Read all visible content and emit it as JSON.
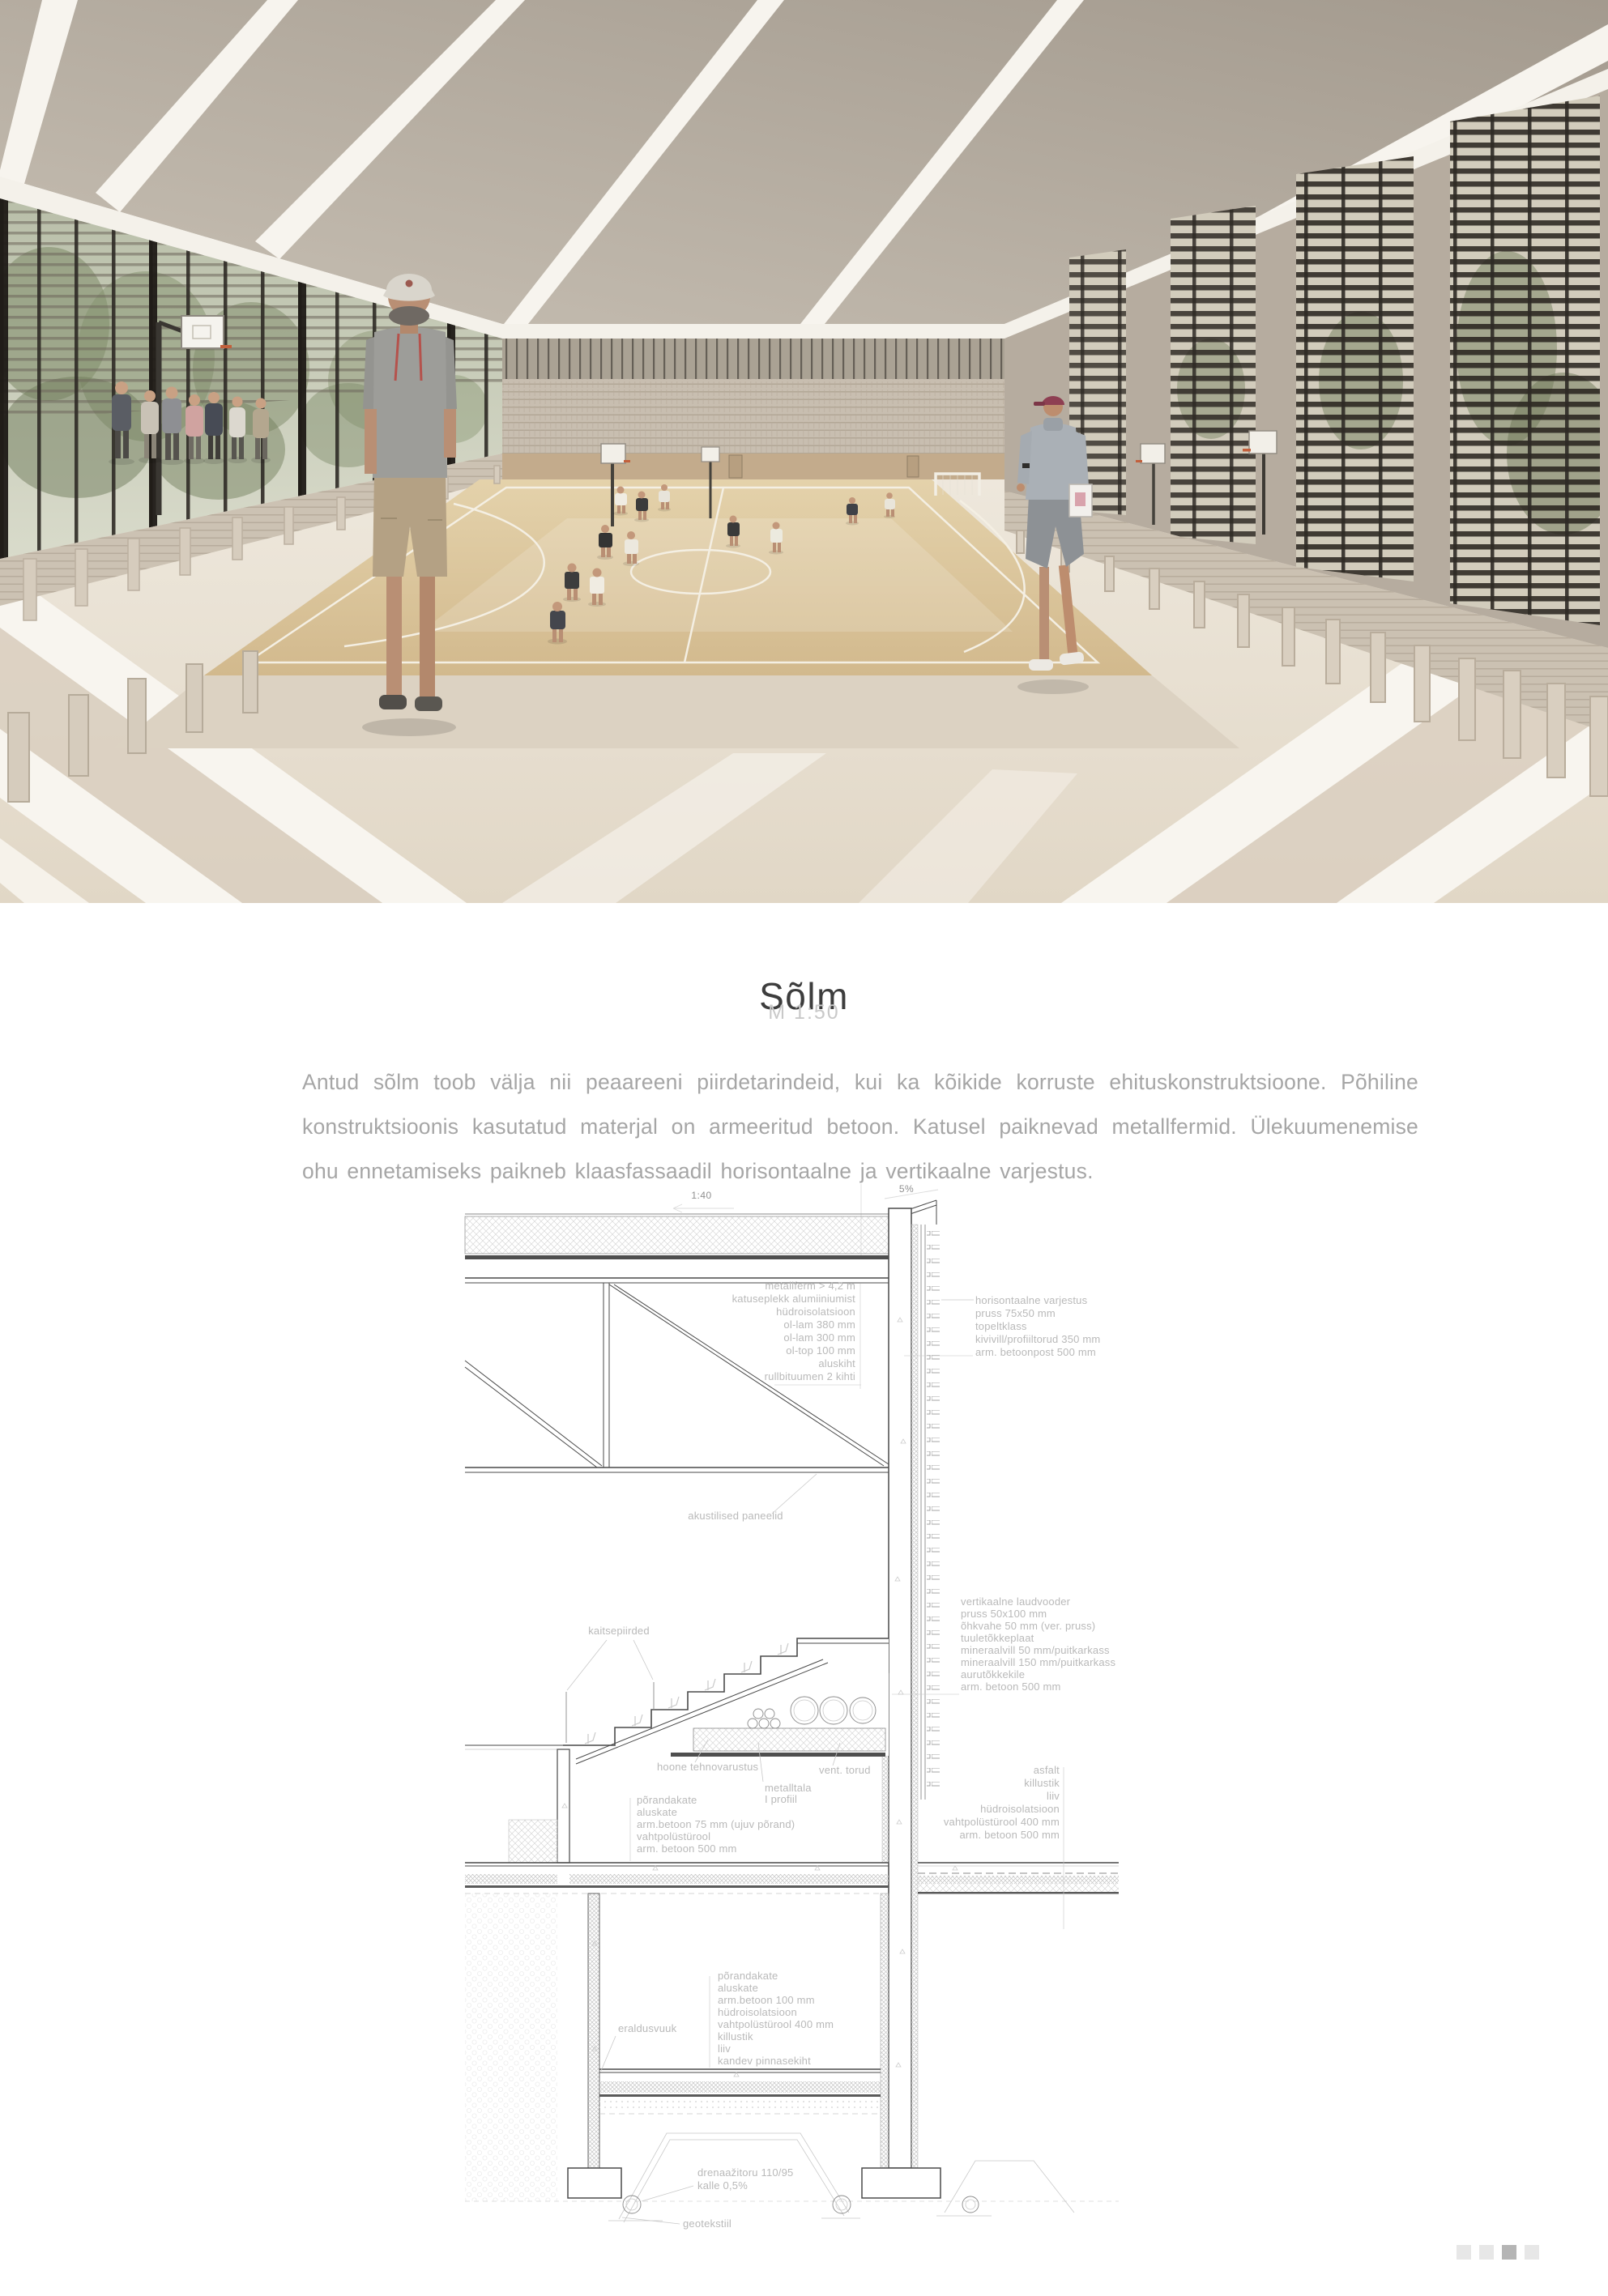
{
  "header": {
    "title": "Sõlm",
    "scale": "M 1:50"
  },
  "intro": {
    "paragraph": "Antud sõlm toob välja nii peaareeni piirdetarindeid, kui ka kõikide korruste ehituskonstruktsioone. Põhiline konstruktsioonis kasutatud materjal on armeeritud betoon. Katusel paiknevad metallfermid. Ülekuumenemise ohu ennetamiseks paikneb klaasfassaadil horisontaalne ja vertikaalne varjestus.",
    "colors": {
      "accent_gray": "#a6a6a6",
      "title": "#3d3d3d",
      "annotation": "#b9b9b9"
    }
  },
  "hero": {
    "colors": {
      "ceiling": "#b3a99e",
      "court": "#d8c096",
      "floor": "#e8e1d4",
      "glass_mullion": "#2e2a25",
      "stand": "#cdc3b4"
    }
  },
  "section": {
    "slope_roof": "1:40",
    "slope_parapet": "5%",
    "roof_layers": [
      "metallferm > 4,2 m",
      "katuseplekk alumiiniumist",
      "hüdroisolatsioon",
      "ol-lam 380 mm",
      "ol-lam 300 mm",
      "ol-top 100 mm",
      "aluskiht",
      "rullbituumen 2 kihti"
    ],
    "shading": [
      "horisontaalne varjestus",
      "pruss 75x50 mm",
      "topeltklass",
      "kivivill/profiiltorud 350 mm",
      "arm. betoonpost 500 mm"
    ],
    "acoustic_panels": "akustilised paneelid",
    "railings": "kaitsepiirded",
    "wall_layers": [
      "vertikaalne laudvooder",
      "pruss 50x100 mm",
      "õhkvahe 50 mm (ver. pruss)",
      "tuuletõkkeplaat",
      "mineraalvill 50 mm/puitkarkass",
      "mineraalvill 150 mm/puitkarkass",
      "aurutõkkekile",
      "arm. betoon 500 mm"
    ],
    "services": "hoone tehnovarustus",
    "vent_pipes": "vent. torud",
    "beam": [
      "metalltala",
      "I profiil"
    ],
    "floor_ground": [
      "põrandakate",
      "aluskate",
      "arm.betoon 75 mm (ujuv põrand)",
      "vahtpolüstürool",
      "arm. betoon 500 mm"
    ],
    "plinth_exterior": [
      "asfalt",
      "killustik",
      "liiv",
      "hüdroisolatsioon",
      "vahtpolüstürool 400 mm",
      "arm. betoon 500 mm"
    ],
    "expansion_joint": "eraldusvuuk",
    "floor_basement": [
      "põrandakate",
      "aluskate",
      "arm.betoon 100 mm",
      "hüdroisolatsioon",
      "vahtpolüstürool 400 mm",
      "killustik",
      "liiv",
      "kandev pinnasekiht"
    ],
    "drainage": [
      "drenaažitoru 110/95",
      "kalle 0,5%"
    ],
    "geotextile": "geotekstiil"
  },
  "pagination": {
    "dots": 4,
    "active": 3,
    "dot_color": "#e7e7e7",
    "active_color": "#b5b5b5"
  }
}
